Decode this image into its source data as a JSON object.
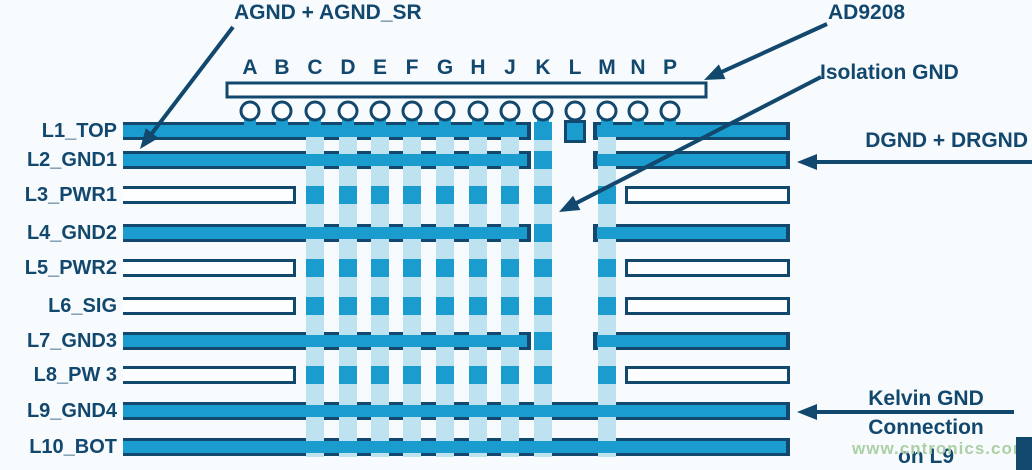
{
  "diagram": {
    "annotations": {
      "agnd": "AGND + AGND_SR",
      "chip": "AD9208",
      "isolation": "Isolation GND",
      "dgnd": "DGND + DRGND",
      "kelvin_line1": "Kelvin GND",
      "kelvin_line2": "Connection",
      "kelvin_line3": "on L9"
    },
    "watermark": "www.cntronics.com",
    "columns": [
      "A",
      "B",
      "C",
      "D",
      "E",
      "F",
      "G",
      "H",
      "J",
      "K",
      "L",
      "M",
      "N",
      "P"
    ],
    "layers": [
      {
        "name": "L1_TOP",
        "type": "plane"
      },
      {
        "name": "L2_GND1",
        "type": "plane"
      },
      {
        "name": "L3_PWR1",
        "type": "outline"
      },
      {
        "name": "L4_GND2",
        "type": "plane"
      },
      {
        "name": "L5_PWR2",
        "type": "outline"
      },
      {
        "name": "L6_SIG",
        "type": "outline"
      },
      {
        "name": "L7_GND3",
        "type": "plane"
      },
      {
        "name": "L8_PW 3",
        "type": "outline"
      },
      {
        "name": "L9_GND4",
        "type": "plane"
      },
      {
        "name": "L10_BOT",
        "type": "plane"
      }
    ],
    "colors": {
      "navy": "#12486e",
      "blue": "#1b9cce",
      "pale": "#bfe2f1",
      "bg": "#f8fbfd",
      "white": "#fdfeff",
      "watermark_green": "#accfa6"
    }
  }
}
